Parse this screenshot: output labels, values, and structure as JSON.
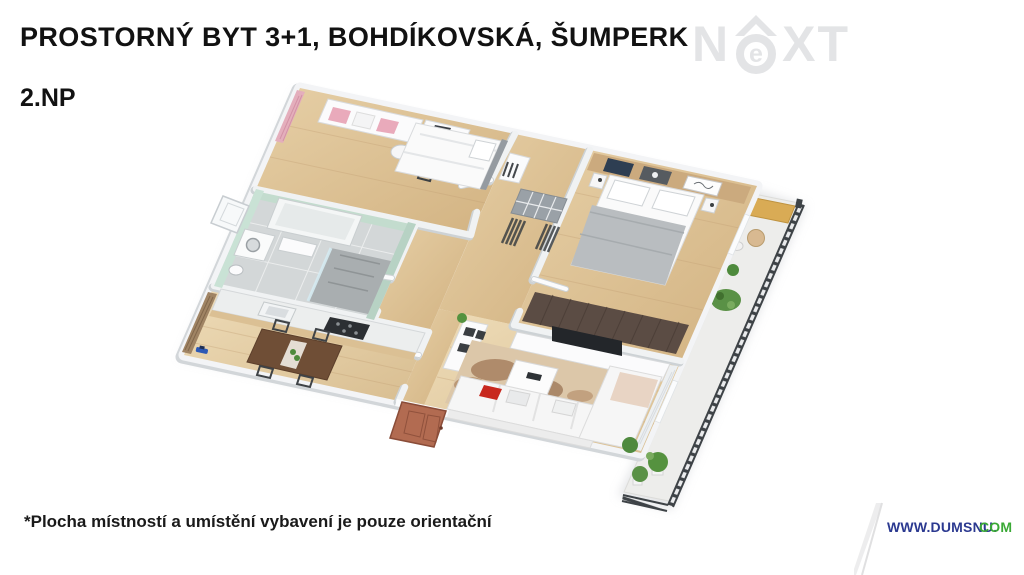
{
  "header": {
    "title": "PROSTORNÝ BYT 3+1, BOHDÍKOVSKÁ, ŠUMPERK",
    "floor_label": "2.NP"
  },
  "brand_watermark": {
    "left": "N",
    "circle_letter": "e",
    "right": "XT"
  },
  "footer": {
    "disclaimer": "*Plocha místností a umístění vybavení je pouze orientační",
    "website": {
      "prefix": "WWW.DUMSNU.",
      "suffix": "COM"
    }
  },
  "colors": {
    "title_text": "#121212",
    "watermark_gray": "#e3e4e6",
    "website_navy": "#2b3990",
    "website_green": "#3aa935",
    "wood_floor": "#ddc096",
    "wood_floor_light": "#e8d2ac",
    "wall_white": "#f3f4f6",
    "mint_tile": "#c3dcce",
    "balcony_railing": "#3e4347",
    "entrance_door": "#b26b51",
    "sofa_white": "#f6f6f6",
    "accent_pillow_red": "#c8281e",
    "plant_green": "#55923f",
    "rug_beige": "#dcc7a9",
    "wardrobe_brown": "#5b4c44"
  }
}
